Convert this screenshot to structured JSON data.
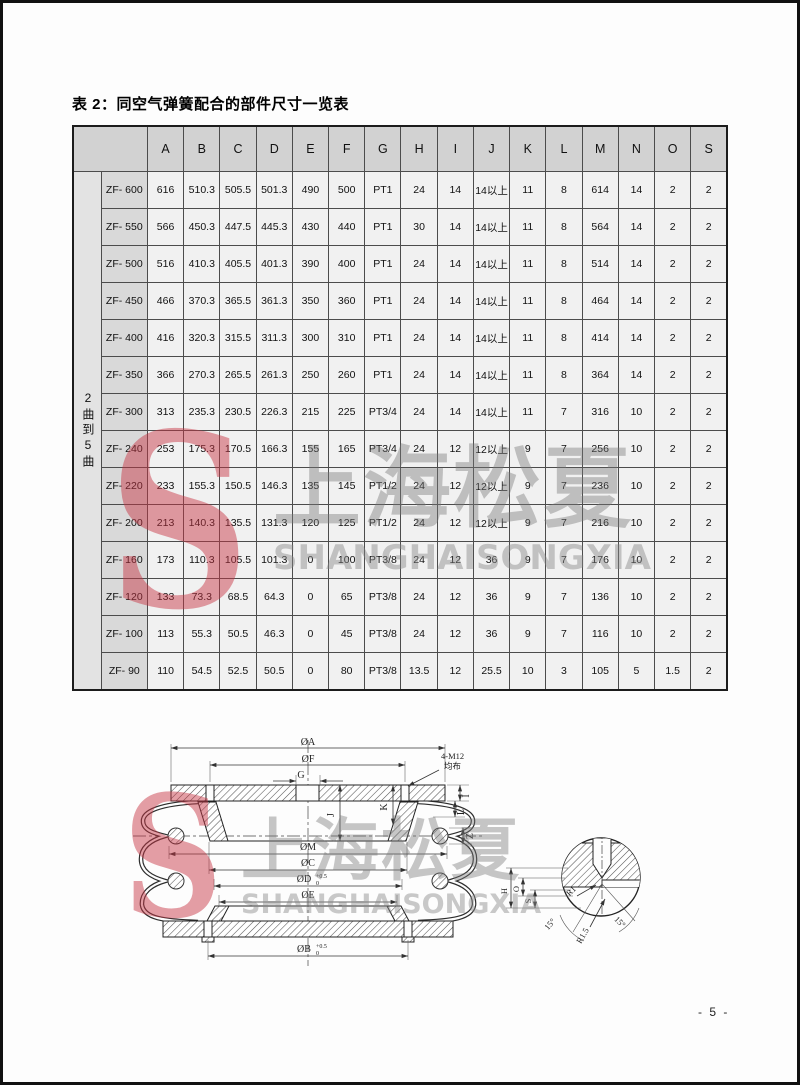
{
  "page": {
    "title": "表 2：同空气弹簧配合的部件尺寸一览表",
    "page_number": "- 5 -"
  },
  "colors": {
    "accent_red": "#c23b47",
    "watermark_gray": "#8f8f8f",
    "header_gray": "#d2d2d2",
    "label_gray": "#d9d9d9",
    "cell_gray": "#f1f1f1"
  },
  "watermark": {
    "logo_letter": "S",
    "cn_text": "上海松夏",
    "en_text": "SHANGHAISONGXIA"
  },
  "table": {
    "row_group_label": "2曲到5曲",
    "columns": [
      "A",
      "B",
      "C",
      "D",
      "E",
      "F",
      "G",
      "H",
      "I",
      "J",
      "K",
      "L",
      "M",
      "N",
      "O",
      "S"
    ],
    "rows": [
      {
        "model": "ZF- 600",
        "values": [
          "616",
          "510.3",
          "505.5",
          "501.3",
          "490",
          "500",
          "PT1",
          "24",
          "14",
          "14以上",
          "11",
          "8",
          "614",
          "14",
          "2",
          "2"
        ]
      },
      {
        "model": "ZF- 550",
        "values": [
          "566",
          "450.3",
          "447.5",
          "445.3",
          "430",
          "440",
          "PT1",
          "30",
          "14",
          "14以上",
          "11",
          "8",
          "564",
          "14",
          "2",
          "2"
        ]
      },
      {
        "model": "ZF- 500",
        "values": [
          "516",
          "410.3",
          "405.5",
          "401.3",
          "390",
          "400",
          "PT1",
          "24",
          "14",
          "14以上",
          "11",
          "8",
          "514",
          "14",
          "2",
          "2"
        ]
      },
      {
        "model": "ZF- 450",
        "values": [
          "466",
          "370.3",
          "365.5",
          "361.3",
          "350",
          "360",
          "PT1",
          "24",
          "14",
          "14以上",
          "11",
          "8",
          "464",
          "14",
          "2",
          "2"
        ]
      },
      {
        "model": "ZF- 400",
        "values": [
          "416",
          "320.3",
          "315.5",
          "311.3",
          "300",
          "310",
          "PT1",
          "24",
          "14",
          "14以上",
          "11",
          "8",
          "414",
          "14",
          "2",
          "2"
        ]
      },
      {
        "model": "ZF- 350",
        "values": [
          "366",
          "270.3",
          "265.5",
          "261.3",
          "250",
          "260",
          "PT1",
          "24",
          "14",
          "14以上",
          "11",
          "8",
          "364",
          "14",
          "2",
          "2"
        ]
      },
      {
        "model": "ZF- 300",
        "values": [
          "313",
          "235.3",
          "230.5",
          "226.3",
          "215",
          "225",
          "PT3/4",
          "24",
          "14",
          "14以上",
          "11",
          "7",
          "316",
          "10",
          "2",
          "2"
        ]
      },
      {
        "model": "ZF- 240",
        "values": [
          "253",
          "175.3",
          "170.5",
          "166.3",
          "155",
          "165",
          "PT3/4",
          "24",
          "12",
          "12以上",
          "9",
          "7",
          "256",
          "10",
          "2",
          "2"
        ]
      },
      {
        "model": "ZF- 220",
        "values": [
          "233",
          "155.3",
          "150.5",
          "146.3",
          "135",
          "145",
          "PT1/2",
          "24",
          "12",
          "12以上",
          "9",
          "7",
          "236",
          "10",
          "2",
          "2"
        ]
      },
      {
        "model": "ZF- 200",
        "values": [
          "213",
          "140.3",
          "135.5",
          "131.3",
          "120",
          "125",
          "PT1/2",
          "24",
          "12",
          "12以上",
          "9",
          "7",
          "216",
          "10",
          "2",
          "2"
        ]
      },
      {
        "model": "ZF- 160",
        "values": [
          "173",
          "110.3",
          "105.5",
          "101.3",
          "0",
          "100",
          "PT3/8",
          "24",
          "12",
          "36",
          "9",
          "7",
          "176",
          "10",
          "2",
          "2"
        ]
      },
      {
        "model": "ZF- 120",
        "values": [
          "133",
          "73.3",
          "68.5",
          "64.3",
          "0",
          "65",
          "PT3/8",
          "24",
          "12",
          "36",
          "9",
          "7",
          "136",
          "10",
          "2",
          "2"
        ]
      },
      {
        "model": "ZF- 100",
        "values": [
          "113",
          "55.3",
          "50.5",
          "46.3",
          "0",
          "45",
          "PT3/8",
          "24",
          "12",
          "36",
          "9",
          "7",
          "116",
          "10",
          "2",
          "2"
        ]
      },
      {
        "model": "ZF- 90",
        "values": [
          "110",
          "54.5",
          "52.5",
          "50.5",
          "0",
          "80",
          "PT3/8",
          "13.5",
          "12",
          "25.5",
          "10",
          "3",
          "105",
          "5",
          "1.5",
          "2"
        ]
      }
    ]
  },
  "diagram": {
    "labels": {
      "dia_a": "ØA",
      "dia_f": "ØF",
      "g": "G",
      "bolt_note_1": "4-M12",
      "bolt_note_2": "均布",
      "i": "I",
      "l": "L",
      "z": "Z",
      "j": "J",
      "k": "K",
      "dia_m": "ØM",
      "dia_c": "ØC",
      "dia_d": "ØD",
      "dia_e": "ØE",
      "dia_b": "ØB",
      "tol_sup": "+0.5",
      "tol_sub": "0"
    },
    "detail": {
      "h": "H",
      "o": "O",
      "s": "S",
      "r1": "R1",
      "r15": "R1.5",
      "angle_left": "15°",
      "angle_right": "15°"
    }
  }
}
